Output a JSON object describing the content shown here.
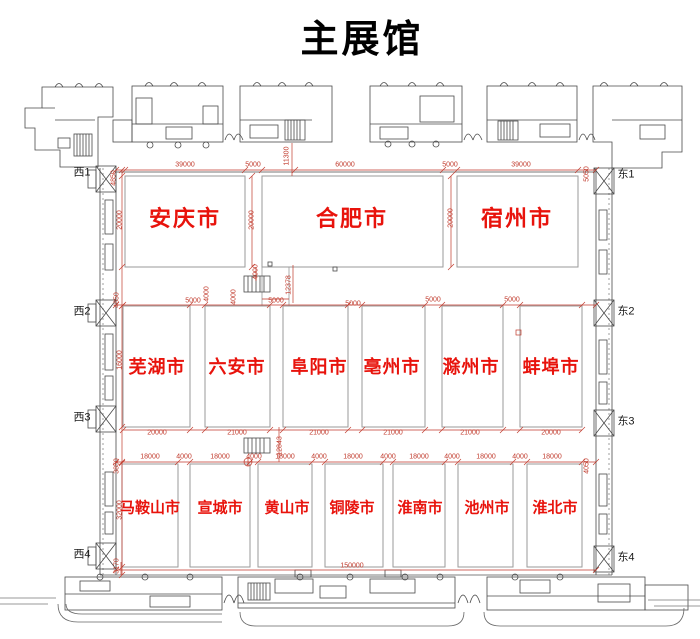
{
  "title": "主展馆",
  "plan": {
    "row1": [
      "安庆市",
      "合肥市",
      "宿州市"
    ],
    "row2": [
      "芜湖市",
      "六安市",
      "阜阳市",
      "亳州市",
      "滁州市",
      "蚌埠市"
    ],
    "row3": [
      "马鞍山市",
      "宣城市",
      "黄山市",
      "铜陵市",
      "淮南市",
      "池州市",
      "淮北市"
    ]
  },
  "gates": {
    "west": [
      "西1",
      "西2",
      "西3",
      "西4"
    ],
    "east": [
      "东1",
      "东2",
      "东3",
      "东4"
    ]
  },
  "dimensions": {
    "top_chain": [
      "4850",
      "39000",
      "5000",
      "11300",
      "60000",
      "5000",
      "39000",
      "5050"
    ],
    "row1_heights": [
      "20000",
      "20000",
      "20000"
    ],
    "band1": {
      "left_edge": "4850",
      "gap1_w": "5000",
      "gap1_h": "4000",
      "stair_top": "4000",
      "stair_side": "4000",
      "stair_w": "5000",
      "corridor_h": "12378",
      "center_w": "5000",
      "gap4_w": "5000",
      "gap5_w": "5000"
    },
    "row2_widths": [
      "20000",
      "21000",
      "21000",
      "21000",
      "21000",
      "20000"
    ],
    "left_chain": [
      "16000",
      "32000",
      "3170"
    ],
    "band2": {
      "corridor_h": "12843"
    },
    "row3_chain": [
      "3850",
      "18000",
      "4000",
      "18000",
      "4000",
      "18000",
      "4000",
      "18000",
      "4000",
      "18000",
      "4000",
      "18000",
      "4000",
      "18000",
      "4050"
    ],
    "bottom_total": "150000"
  },
  "colors": {
    "dimension_red": "#c0392b",
    "label_red": "#e8130c",
    "line_gray": "#4a4a4a"
  }
}
